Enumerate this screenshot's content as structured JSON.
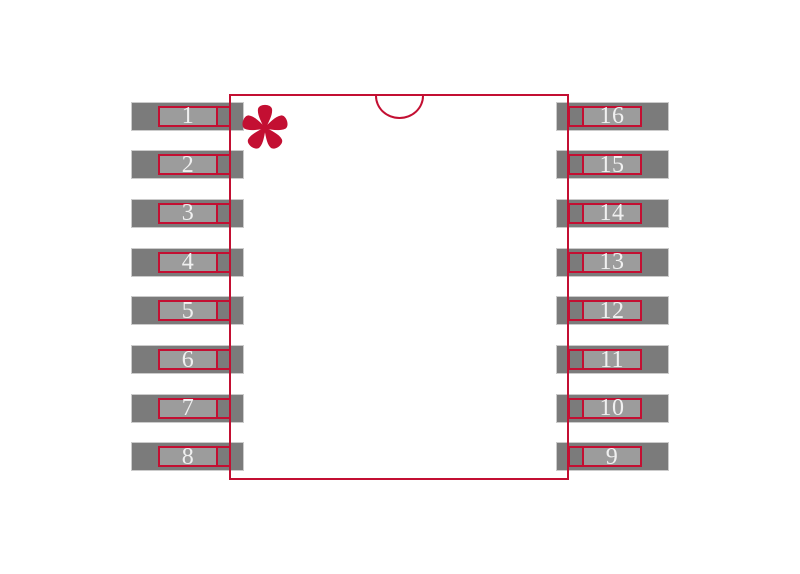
{
  "colors": {
    "outline_red": "#C30F32",
    "pad_gray": "#7B7B7B",
    "pin_fill_gray": "#9C9C9C",
    "pad_edge_gray": "#CBCBCB",
    "pin_number_white": "#F0F0F0",
    "background": "#FFFFFF"
  },
  "pins": {
    "count": 16,
    "left_numbers": [
      "1",
      "2",
      "3",
      "4",
      "5",
      "6",
      "7",
      "8"
    ],
    "right_numbers": [
      "16",
      "15",
      "14",
      "13",
      "12",
      "11",
      "10",
      "9"
    ]
  },
  "pin1_marker": {
    "symbol": "*"
  }
}
